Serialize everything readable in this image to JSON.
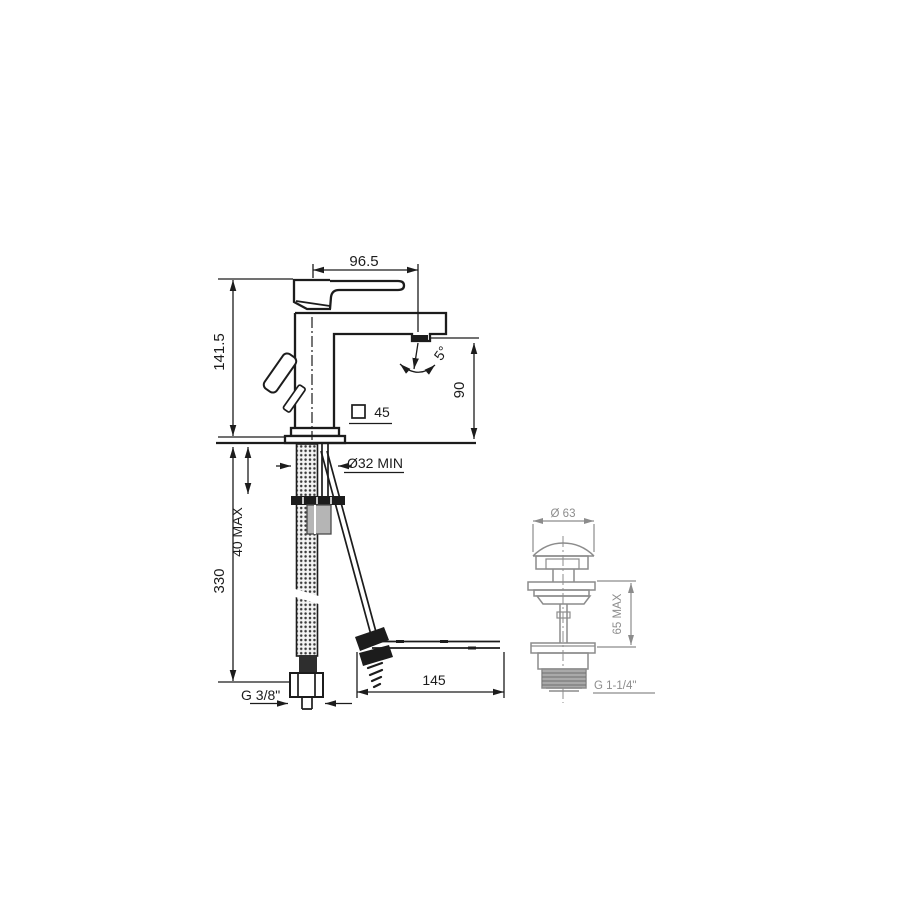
{
  "page": {
    "background": "#ffffff"
  },
  "drawing": {
    "primary_color": "#1c1c1c",
    "secondary_color": "#8c8c8c",
    "faucet_view": "single-lever basin mixer - side elevation",
    "drain_view": "pop-up waste drain - side elevation",
    "labels": {
      "spout_reach": "96.5",
      "overall_height": "141.5",
      "swivel_angle": "5°",
      "outlet_height": "90",
      "base_square": "45",
      "hole_diameter": "Ø32 MIN",
      "deck_thickness": "40 MAX",
      "hose_length": "330",
      "inlet_thread": "G 3/8\"",
      "rod_reach": "145",
      "waste_cap_diameter": "Ø 63",
      "waste_deck_max": "65 MAX",
      "waste_thread": "G 1-1/4\""
    }
  }
}
